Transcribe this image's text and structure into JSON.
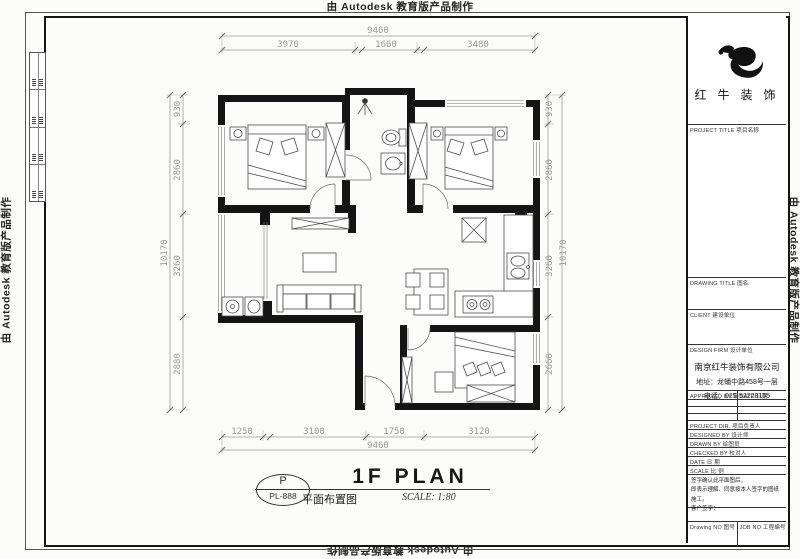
{
  "watermark": "由 Autodesk 教育版产品制作",
  "plan": {
    "dims": {
      "top": {
        "total": "9460",
        "segments": [
          "3970",
          "1660",
          "3480"
        ]
      },
      "bottom": {
        "total": "9460",
        "segments": [
          "1250",
          "3100",
          "1750",
          "3120"
        ]
      },
      "left": {
        "total": "10170",
        "segments": [
          "930",
          "2860",
          "3260",
          "2880"
        ]
      },
      "right": {
        "total": "10170",
        "segments": [
          "930",
          "2860",
          "3260",
          "2660"
        ]
      }
    },
    "stamp": {
      "letter": "P",
      "number": "PL-888"
    },
    "title": "1F PLAN",
    "subtitle": "平面布置图",
    "scale": "SCALE: 1:80"
  },
  "titleblock": {
    "logo_text": "红 牛 装 饰",
    "project_title_label": "PROJECT TITLE 项目名称",
    "drawing_title_label": "DRAWING TITLE 图名",
    "client_label": "CLIENT 建设单位",
    "design_firm_label": "DESIGN FIRM 设计单位",
    "company": {
      "name": "南京红牛装饰有限公司",
      "address": "地址：龙蟠中路458号一层",
      "phone": "电话：025-52228155"
    },
    "approved_label": "APPROVED BY 审定",
    "date_label": "DATE 日期",
    "fields": [
      {
        "label": "PROJECT DIR. 项目负责人"
      },
      {
        "label": "DESIGNED BY 设计师"
      },
      {
        "label": "DRAWN BY 绘图员"
      },
      {
        "label": "CHECKED BY 校对人"
      },
      {
        "label": "DATE 日 期"
      },
      {
        "label": "SCALE 比 例"
      }
    ],
    "note_lines": [
      "签字确认此平面图后，",
      "即表示理解、同意按本人签字的图纸施工。",
      "客户签字："
    ],
    "drawing_no_label": "Drawing NO 图号",
    "job_no_label": "JOB NO 工程编号"
  }
}
